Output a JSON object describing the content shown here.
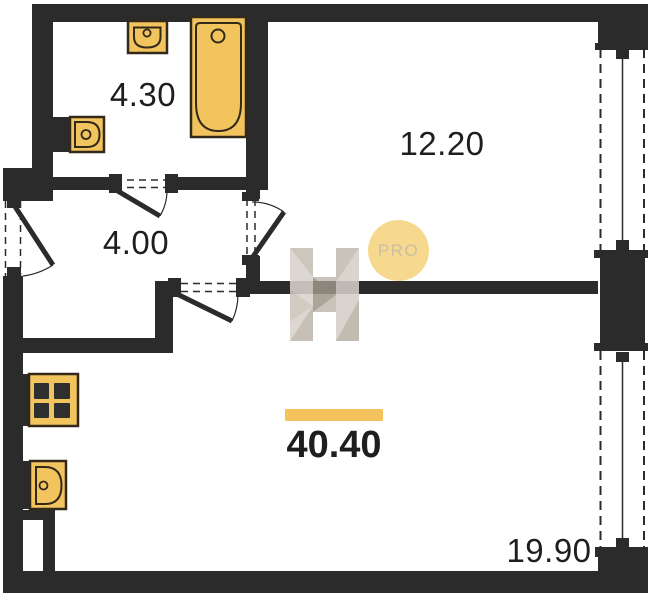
{
  "plan": {
    "title": "apartment-floor-plan",
    "rooms": [
      {
        "id": "bathroom",
        "area": "4.30"
      },
      {
        "id": "hallway",
        "area": "4.00"
      },
      {
        "id": "bedroom",
        "area": "12.20"
      },
      {
        "id": "living-kitchen",
        "area": "19.90"
      }
    ],
    "total_area": "40.40",
    "watermark": {
      "logo_letter": "H",
      "badge": "PRO"
    },
    "fixtures": [
      "bathtub",
      "wash-sink-top",
      "wash-sink-side",
      "stove-4-burners",
      "kitchen-sink"
    ],
    "colors": {
      "background": "#ffffff",
      "wall": "#2b2b2b",
      "fixture_fill": "#f2c45e",
      "fixture_stroke": "#33291b",
      "burner": "#2f2f2f",
      "accent_bar": "#f5c35e",
      "badge_fill": "#f6d98e",
      "badge_text": "#c9bfa4",
      "label_text": "#1e1e1e"
    }
  }
}
